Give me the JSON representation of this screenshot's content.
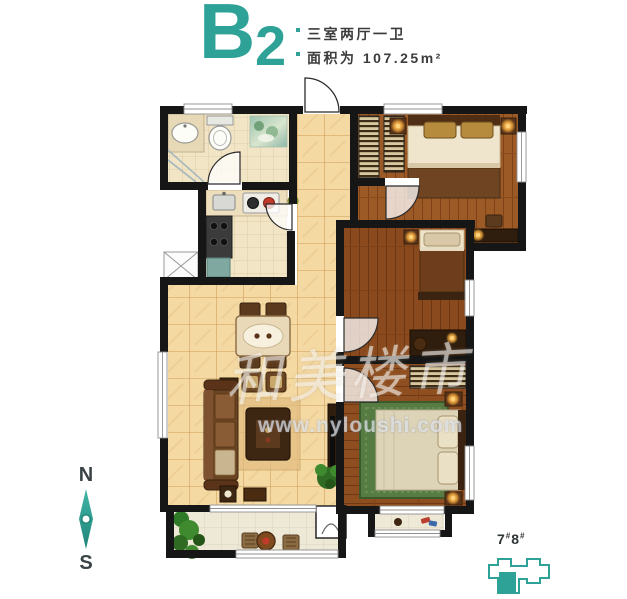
{
  "header": {
    "plan_letter": "B",
    "plan_number": "2",
    "spec_rooms": "三室两厅一卫",
    "spec_area": "面积为 107.25m²"
  },
  "compass": {
    "north": "N",
    "south": "S"
  },
  "watermark": {
    "brand": "和美楼市",
    "url": "www.nyloushi.com"
  },
  "badge": {
    "num1": "7",
    "hash1": "#",
    "num2": "8",
    "hash2": "#"
  },
  "colors": {
    "accent": "#2EA296",
    "wall": "#161616",
    "text": "#3C3C3C",
    "wood_light": "#9C5A27",
    "wood_dark": "#8A4A1D",
    "tile_hall": "#F4D9A3",
    "tile_small": "#F2E5C6",
    "tile_balcony": "#EEE8D6"
  }
}
